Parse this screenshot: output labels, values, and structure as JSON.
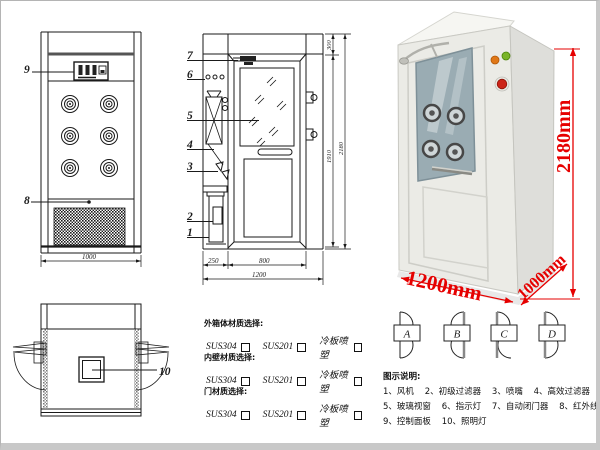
{
  "front_view": {
    "callout_9": "9",
    "callout_8": "8",
    "width_dim": "1000"
  },
  "side_view": {
    "callouts": {
      "c1": "1",
      "c2": "2",
      "c3": "3",
      "c4": "4",
      "c5": "5",
      "c6": "6",
      "c7": "7"
    },
    "dims": {
      "left_section": "250",
      "door_width": "800",
      "total_width": "1200",
      "top": "300",
      "door_height": "1910",
      "total_height": "2180"
    }
  },
  "top_view": {
    "callout_10": "10"
  },
  "photo": {
    "height_label": "2180mm",
    "width_label": "1200mm",
    "depth_label": "1000mm",
    "dim_color": "#e60000"
  },
  "materials": {
    "sections": [
      {
        "label": "外箱体材质选择:",
        "opt1": "SUS304",
        "opt2": "SUS201",
        "opt3": "冷板喷塑"
      },
      {
        "label": "内壁材质选择:",
        "opt1": "SUS304",
        "opt2": "SUS201",
        "opt3": "冷板喷塑"
      },
      {
        "label": "门材质选择:",
        "opt1": "SUS304",
        "opt2": "SUS201",
        "opt3": "冷板喷塑"
      }
    ]
  },
  "door_configs": {
    "a": "A",
    "b": "B",
    "c": "C",
    "d": "D"
  },
  "legend": {
    "title": "图示说明:",
    "line1": "1、风机    2、初级过滤器    3、喷嘴    4、高效过滤器",
    "line2": "5、玻璃视窗    6、指示灯    7、自动闭门器    8、红外线感应器",
    "line3": "9、控制面板    10、照明灯"
  }
}
